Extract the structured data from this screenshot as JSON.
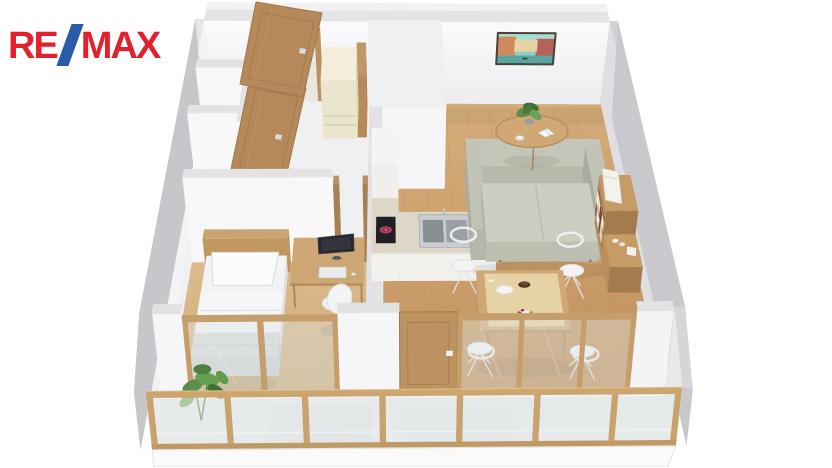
{
  "page": {
    "background": "#ffffff"
  },
  "logo": {
    "re": "RE",
    "slash": "/",
    "max": "MAX"
  },
  "floorplan": {
    "type": "3d-floor-plan-render",
    "view": "isometric top-down apartment visualization",
    "colors": {
      "pageBg": "#ffffff",
      "logoRed": "#e2202e",
      "logoBlue": "#2a5ba9",
      "wallTop": "#e4e4e7",
      "wallFace": "#f7f7f9",
      "wallShade": "#e2e2e6",
      "wallOuter": "#c7c7cb",
      "woodFloor": "#cda36f",
      "woodFloorBed": "#d7b587",
      "hallFloor": "#eff0f1",
      "balconyFloor": "#ebebed",
      "doorWood": "#b5895a",
      "frameWood": "#bb9160",
      "cream": "#eae6ce",
      "counterTop": "#ded7c7",
      "cabinetFront": "#f2f1ee",
      "steel": "#c9cdd0",
      "steelDark": "#878e94",
      "cooktop": "#202024",
      "burner": "#b4425f",
      "sofa": "#c3c6b9",
      "sofaSeat": "#cbcec1",
      "tableWood": "#cfa876",
      "chairWhite": "#f3f3f5",
      "bedWhite": "#f3f3f5",
      "blanket": "#d9d9dd",
      "headboard": "#cba271",
      "shelfWood": "#bb8f5c",
      "glass": "#dfe6e4",
      "glassFrame": "#c59e6b",
      "paintSky": "#8ecfc7",
      "paintWater": "#58a5a1",
      "paintWarm": "#cf8a5c",
      "paintRust": "#b4635a",
      "monitor": "#26262b",
      "plantGreen": "#5d8f49",
      "plantDark": "#3f7034"
    },
    "rooms": [
      {
        "name": "entry-hall"
      },
      {
        "name": "bathroom-core"
      },
      {
        "name": "closets"
      },
      {
        "name": "bedroom"
      },
      {
        "name": "kitchen"
      },
      {
        "name": "living-dining-room"
      },
      {
        "name": "balcony"
      }
    ],
    "furniture": [
      "entry-door-open",
      "bathroom-door-open",
      "cream-wardrobe-fridge",
      "single-bed-with-headboard",
      "desk-with-monitor-keyboard",
      "white-office-chair",
      "kitchen-counter-with-sink",
      "induction-cooktop",
      "tall-kitchen-cabinet",
      "green-grey-sofa",
      "round-coffee-table-with-plant-book-cup",
      "venice-canal-wall-painting",
      "wooden-bookshelf-with-books",
      "dining-table-with-plates-and-fruit",
      "four-white-wire-chairs",
      "monstera-plant",
      "glazed-partition-doors",
      "balcony-glazing"
    ]
  }
}
